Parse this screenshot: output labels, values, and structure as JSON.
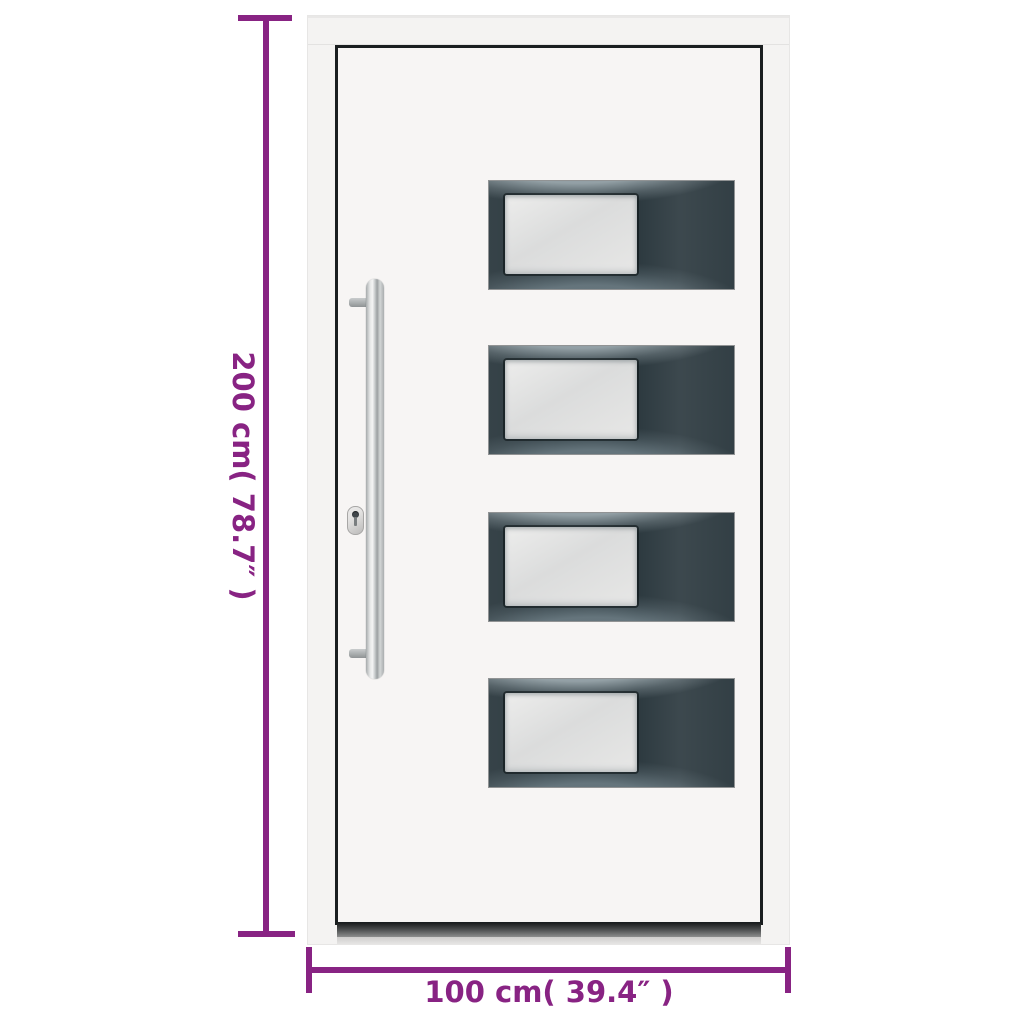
{
  "image": {
    "type": "product-dimension-diagram",
    "subject": "white front door with four anthracite glazed panels and bar handle"
  },
  "dimensions": {
    "height": {
      "label": "200 cm( 78.7″ )",
      "value_cm": 200,
      "value_inch": 78.7
    },
    "width": {
      "label": "100 cm( 39.4″ )",
      "value_cm": 100,
      "value_inch": 39.4
    },
    "annotation_color": "#882383"
  },
  "door": {
    "frame_color": "#f4f3f2",
    "slab_color": "#f7f5f4",
    "outline_color": "#1a1e20",
    "panel_color": "#2c393f",
    "glass_color": "#e2e2e1",
    "handle_color": "#c9cdce",
    "panel_count": 4,
    "panels": [
      {
        "id": 1,
        "glass": "frosted"
      },
      {
        "id": 2,
        "glass": "frosted"
      },
      {
        "id": 3,
        "glass": "frosted"
      },
      {
        "id": 4,
        "glass": "frosted"
      }
    ]
  }
}
